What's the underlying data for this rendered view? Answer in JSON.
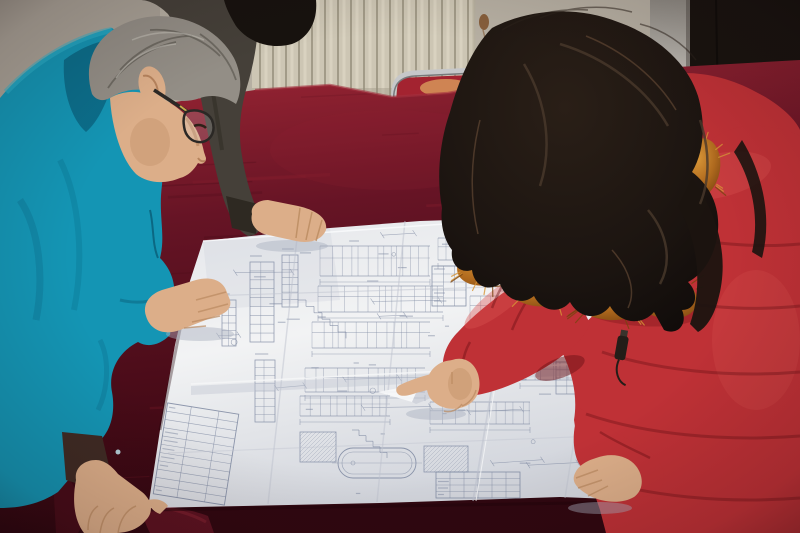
{
  "scene": {
    "description": "two-workers-reviewing-large-folded-blueprint-on-red-velvet-table",
    "left_person": "man-in-teal-work-jacket-with-glasses",
    "back_person": "bystander-in-dark-jacket",
    "right_person": "woman-in-red-down-coat-with-fur-collar-pointing",
    "surface": "red-velvet-covered-table",
    "document": "large-folded-construction-detail-drawing",
    "background_objects": [
      "radiator-panel-wall",
      "beige-wall",
      "rust-stain",
      "door-frame",
      "dark-door",
      "metal-frame-chair"
    ]
  },
  "colors": {
    "wall": "#b6afa2",
    "wall_shade": "#9d968c",
    "radiator_base": "#cdc6b4",
    "radiator_groove": "#948d7a",
    "radiator_highlight": "#e6dfcc",
    "radiator_edge": "#a29b88",
    "stain": "#7a4a22",
    "frame_light": "#eceae3",
    "frame_mid": "#8f8b84",
    "door_dark": "#18130f",
    "chrome": "#c6c7c9",
    "chrome_dark": "#77797b",
    "chair_red": "#a32330",
    "chair_glow": "#dda55f",
    "velvet_light": "#8e2130",
    "velvet_mid": "#661425",
    "velvet_dark": "#440a16",
    "velvet_front": "#300710",
    "velvet_fold": "#7c1f2e",
    "table_edge": "#a33040",
    "paper_light": "#f2f3f4",
    "paper_mid": "#e4e6ea",
    "paper_dark": "#d3d6dd",
    "paper_shadow": "#bfc3cf",
    "line_color": "#7c87a0",
    "teal": "#1495b4",
    "teal_dark": "#0b6e8b",
    "teal_deep": "#07556e",
    "teal_light": "#2fb3cc",
    "cuff_lining": "#3f2b24",
    "hair_gray": "#938e86",
    "hair_gray_dark": "#4f4a44",
    "hair_gray_light": "#c2beb5",
    "skin": "#dcae89",
    "skin_shadow": "#b9895f",
    "skin_deep": "#a5714a",
    "glasses_frame": "#2b2825",
    "glasses_glint": "#c8a84a",
    "bystander_jacket": "#454039",
    "bystander_dark": "#2e2922",
    "bystander_hair": "#17120e",
    "woman_hair": "#1b1410",
    "woman_hair_hl1": "#4a392c",
    "woman_hair_hl2": "#6b4f38",
    "fur_light": "#d89637",
    "fur_mid": "#b06a1e",
    "fur_dark": "#7a4410",
    "coat": "#bf3136",
    "coat_light": "#d95250",
    "coat_dark": "#8c1b20",
    "coat_deep": "#6e1216",
    "zipper": "#241d18",
    "face_skin": "#d09a72",
    "shadow_on_paper": "#a9afbe"
  }
}
